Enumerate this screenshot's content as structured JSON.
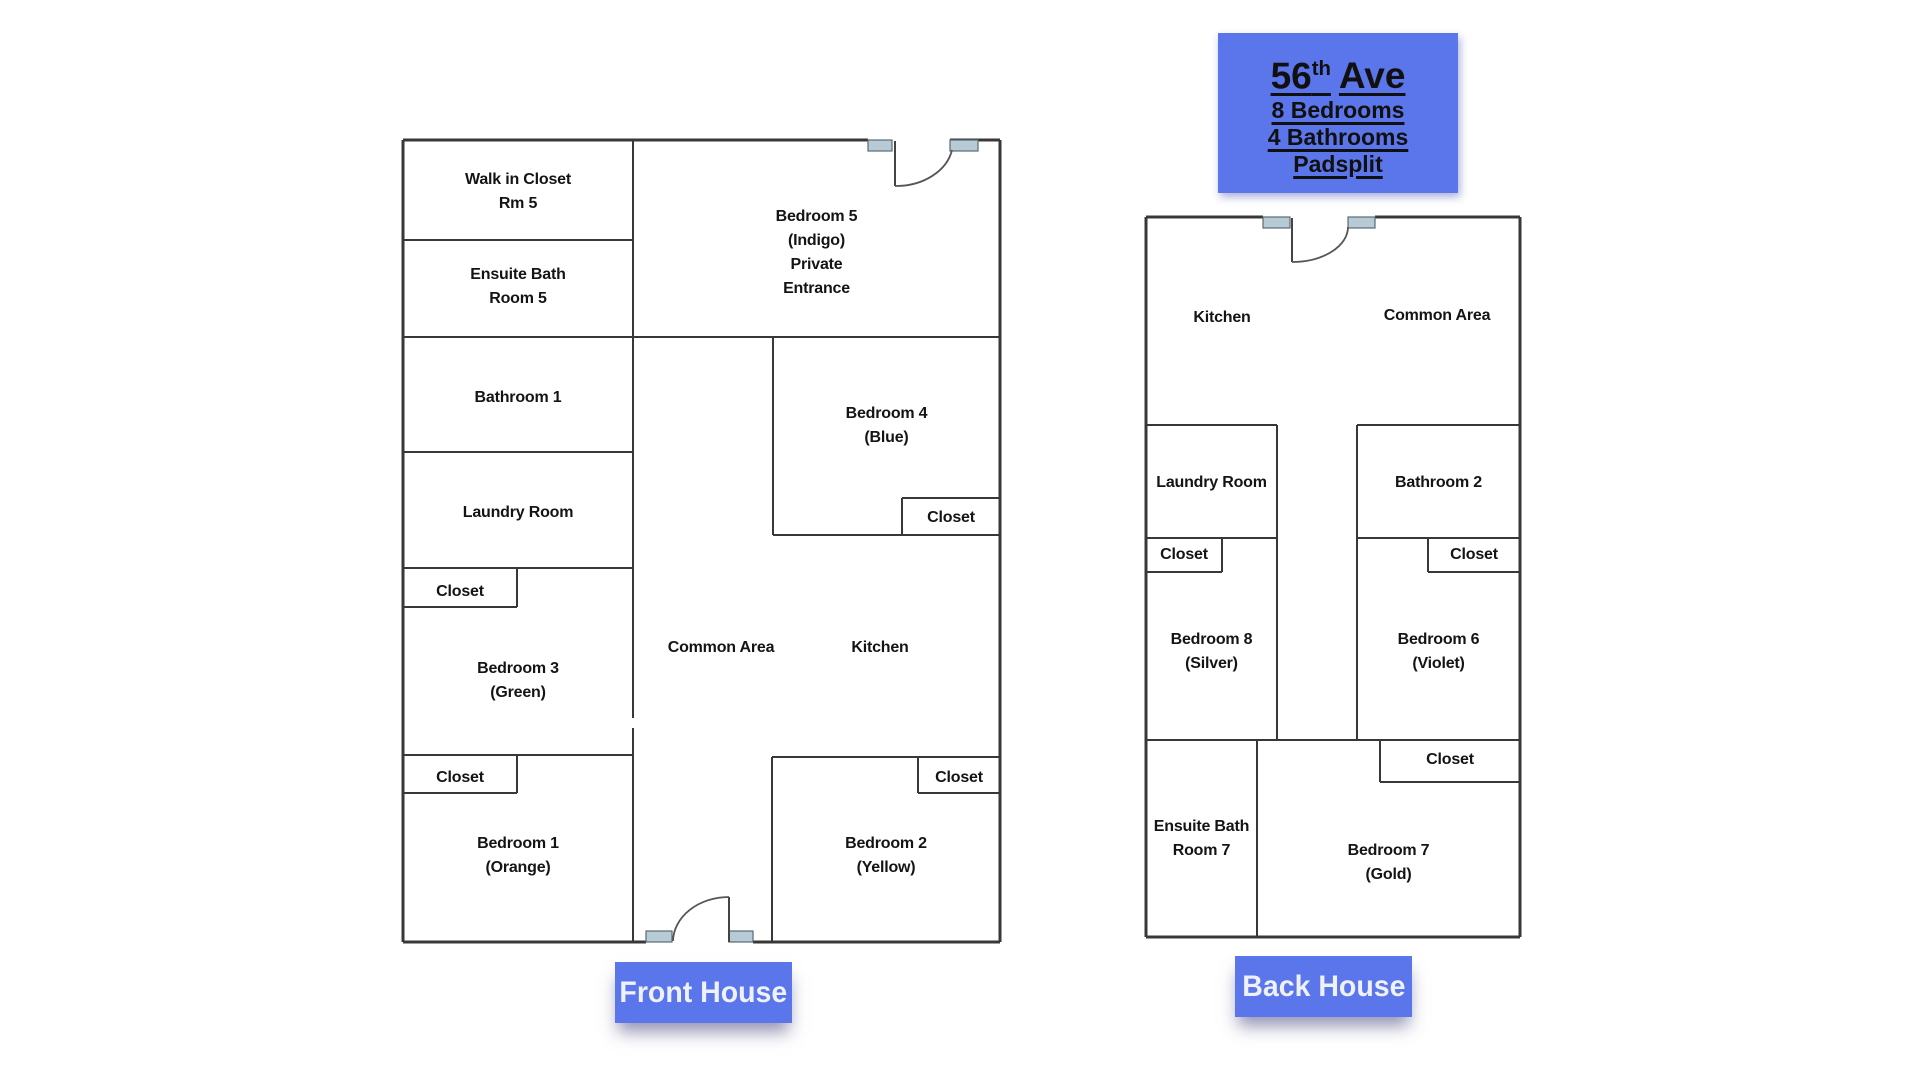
{
  "title": {
    "street_number": "56",
    "street_sup": "th",
    "street_name": "Ave",
    "details": [
      "8 Bedrooms",
      "4 Bathrooms",
      "Padsplit"
    ]
  },
  "front": {
    "label": "Front House",
    "rooms": {
      "walk_in_closet": "Walk in Closet\nRm 5",
      "ensuite_bath": "Ensuite Bath\nRoom 5",
      "bathroom1": "Bathroom 1",
      "laundry": "Laundry Room",
      "closet_b3": "Closet",
      "bedroom3": "Bedroom 3\n(Green)",
      "closet_b1": "Closet",
      "bedroom1": "Bedroom 1\n(Orange)",
      "bedroom5": "Bedroom 5\n(Indigo)\nPrivate\nEntrance",
      "bedroom4": "Bedroom 4\n(Blue)",
      "closet_b4": "Closet",
      "common": "Common Area",
      "kitchen": "Kitchen",
      "closet_b2": "Closet",
      "bedroom2": "Bedroom 2\n(Yellow)"
    }
  },
  "back": {
    "label": "Back House",
    "rooms": {
      "kitchen": "Kitchen",
      "common": "Common Area",
      "laundry": "Laundry Room",
      "closet_b8": "Closet",
      "bedroom8": "Bedroom 8\n(Silver)",
      "bathroom2": "Bathroom 2",
      "closet_b6": "Closet",
      "bedroom6": "Bedroom 6\n(Violet)",
      "ensuite": "Ensuite Bath\nRoom 7",
      "closet_b7": "Closet",
      "bedroom7": "Bedroom 7\n(Gold)"
    }
  },
  "colors": {
    "accent_blue": "#5b76ea",
    "wall": "#383838",
    "door_hinge_fill": "#b7cbd7",
    "label_text": "#141414",
    "tag_text": "#eef1f8"
  }
}
